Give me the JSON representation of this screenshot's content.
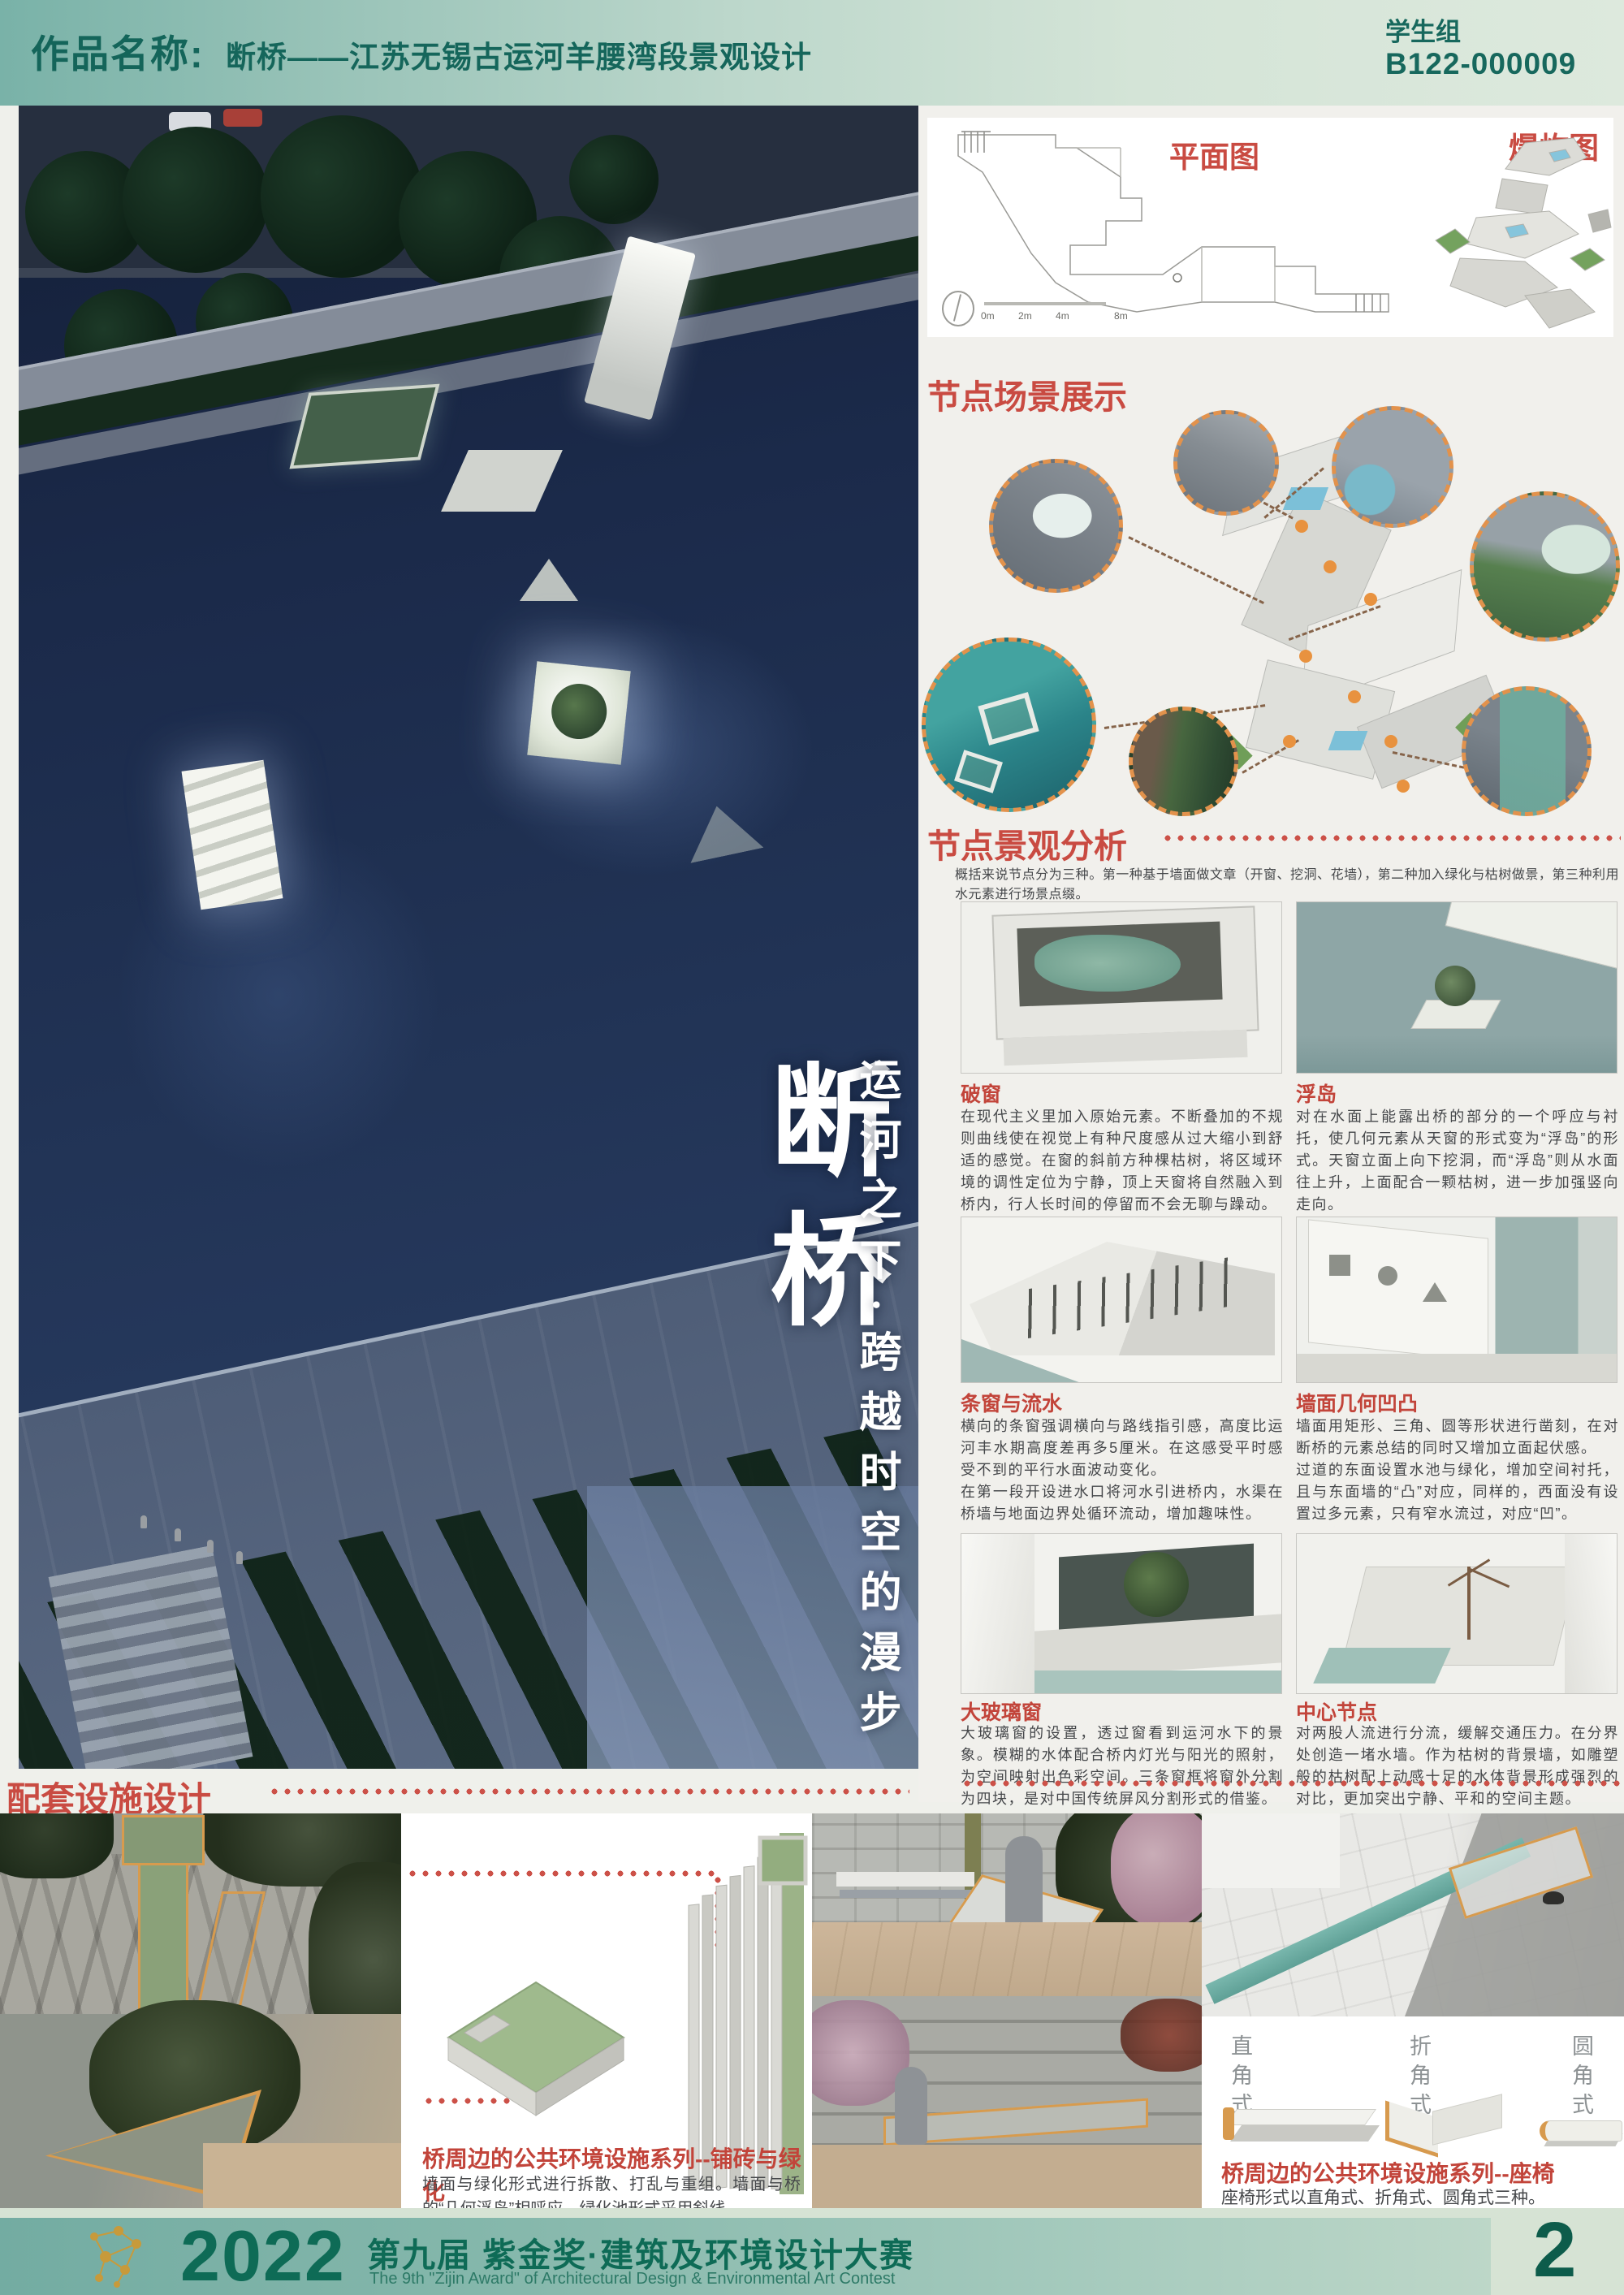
{
  "header": {
    "label": "作品名称:",
    "title": "断桥——江苏无锡古运河羊腰湾段景观设计",
    "group": "学生组",
    "entry_no": "B122-000009"
  },
  "hero": {
    "title": "断桥",
    "subtitle": "运河之下·跨越时空的漫步"
  },
  "plan_panel": {
    "plan_label": "平面图",
    "exploded_label": "爆炸图",
    "scale_labels": [
      "0m",
      "2m",
      "4m",
      "8m"
    ]
  },
  "scene_section": {
    "title": "节点场景展示"
  },
  "analysis_section": {
    "title": "节点景观分析",
    "intro": "概括来说节点分为三种。第一种基于墙面做文章（开窗、挖洞、花墙），第二种加入绿化与枯树做景，第三种利用水元素进行场景点缀。",
    "cards": [
      {
        "title": "破窗",
        "text": "在现代主义里加入原始元素。不断叠加的不规则曲线使在视觉上有种尺度感从过大缩小到舒适的感觉。在窗的斜前方种棵枯树，将区域环境的调性定位为宁静，顶上天窗将自然融入到桥内，行人长时间的停留而不会无聊与躁动。"
      },
      {
        "title": "浮岛",
        "text": "对在水面上能露出桥的部分的一个呼应与衬托，使几何元素从天窗的形式变为“浮岛”的形式。天窗立面上向下挖洞，而“浮岛”则从水面往上升，上面配合一颗枯树，进一步加强竖向走向。"
      },
      {
        "title": "条窗与流水",
        "text": "横向的条窗强调横向与路线指引感，高度比运河丰水期高度差再多5厘米。在这感受平时感受不到的平行水面波动变化。\n在第一段开设进水口将河水引进桥内，水渠在桥墙与地面边界处循环流动，增加趣味性。"
      },
      {
        "title": "墙面几何凹凸",
        "text": "墙面用矩形、三角、圆等形状进行凿刻，在对断桥的元素总结的同时又增加立面起伏感。\n过道的东面设置水池与绿化，增加空间衬托，且与东面墙的“凸”对应，同样的，西面没有设置过多元素，只有窄水流过，对应“凹”。"
      },
      {
        "title": "大玻璃窗",
        "text": "大玻璃窗的设置，透过窗看到运河水下的景象。模糊的水体配合桥内灯光与阳光的照射，为空间映射出色彩空间。三条窗框将窗外分割为四块，是对中国传统屏风分割形式的借鉴。"
      },
      {
        "title": "中心节点",
        "text": "对两股人流进行分流，缓解交通压力。在分界处创造一堵水墙。作为枯树的背景墙，如雕塑般的枯树配上动感十足的水体背景形成强烈的对比，更加突出宁静、平和的空间主题。"
      }
    ]
  },
  "facilities_section": {
    "title": "配套设施设计",
    "paving": {
      "title": "桥周边的公共环境设施系列--铺砖与绿化",
      "desc": "墙面与绿化形式进行拆散、打乱与重组。墙面与桥的“几何浮岛”相呼应。绿化池形式采用斜线。"
    },
    "bench": {
      "title": "桥周边的公共环境设施系列--座椅",
      "desc": "座椅形式以直角式、折角式、圆角式三种。",
      "types": [
        "直角式",
        "折角式",
        "圆角式"
      ]
    }
  },
  "footer": {
    "year": "2022",
    "title_cn": "第九届 紫金奖·建筑及环境设计大赛",
    "title_en": "The 9th \"Zijin Award\" of Architectural Design & Environmental Art Contest",
    "page": "2"
  },
  "colors": {
    "accent_red": "#c94b42",
    "accent_orange": "#e2924c",
    "brand_green": "#14655a",
    "footer_teal": "#7cb3a8",
    "water_navy": "#1e2d4d",
    "model_teal": "#8ea6a6"
  }
}
